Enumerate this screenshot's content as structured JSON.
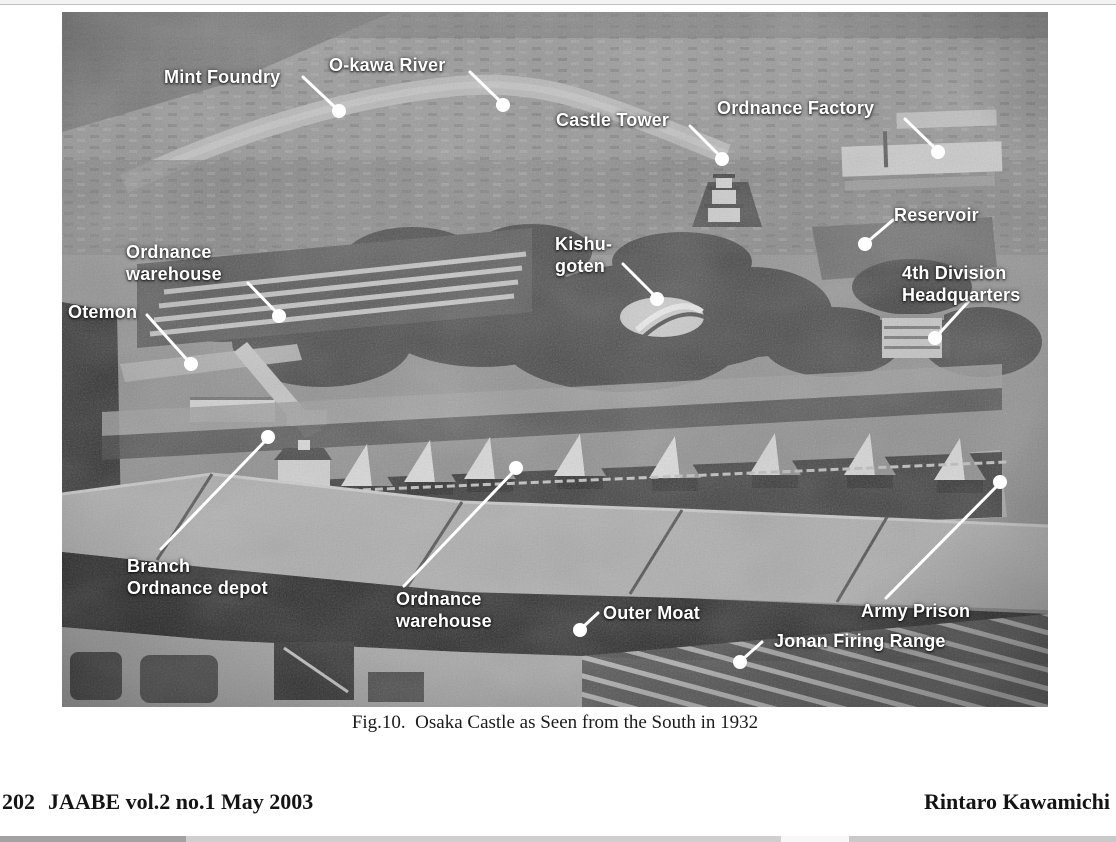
{
  "page": {
    "caption": "Fig.10.  Osaka Castle as Seen from the South in 1932",
    "footer": {
      "page_number": "202",
      "journal_info": "JAABE vol.2 no.1 May 2003",
      "author": "Rintaro Kawamichi"
    }
  },
  "figure": {
    "label_color": "#ffffff",
    "labels": [
      {
        "id": "mint-foundry",
        "text": "Mint Foundry"
      },
      {
        "id": "okawa-river",
        "text": "O-kawa River"
      },
      {
        "id": "castle-tower",
        "text": "Castle Tower"
      },
      {
        "id": "ordnance-factory",
        "text": "Ordnance Factory"
      },
      {
        "id": "reservoir",
        "text": "Reservoir"
      },
      {
        "id": "ordnance-warehouse-north",
        "text": "Ordnance\nwarehouse"
      },
      {
        "id": "kishu-goten",
        "text": "Kishu-\ngoten"
      },
      {
        "id": "fourth-division-hq",
        "text": "4th Division\nHeadquarters"
      },
      {
        "id": "otemon",
        "text": "Otemon"
      },
      {
        "id": "branch-ordnance-depot",
        "text": "Branch\nOrdnance depot"
      },
      {
        "id": "ordnance-warehouse-south",
        "text": "Ordnance\nwarehouse"
      },
      {
        "id": "outer-moat",
        "text": "Outer Moat"
      },
      {
        "id": "army-prison",
        "text": "Army Prison"
      },
      {
        "id": "jonan-firing-range",
        "text": "Jonan Firing Range"
      }
    ]
  }
}
